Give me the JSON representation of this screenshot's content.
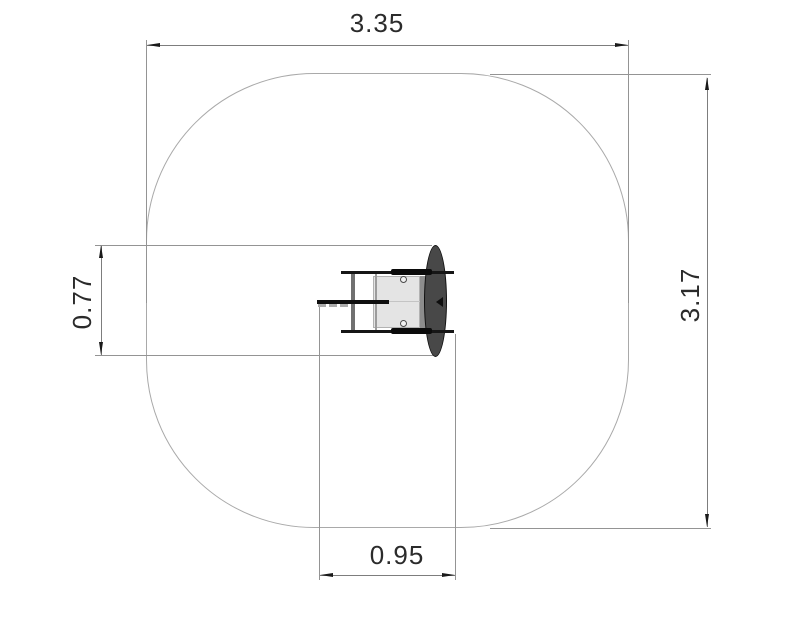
{
  "drawing": {
    "kind": "plan-view dimension drawing",
    "dimensions": {
      "overall_width": {
        "label": "3.35"
      },
      "overall_height": {
        "label": "3.17"
      },
      "equipment_depth": {
        "label": "0.77"
      },
      "equipment_width": {
        "label": "0.95"
      }
    },
    "colors": {
      "background": "#ffffff",
      "outline_gray": "#a9a9a9",
      "dimension_line_gray": "#7d7d7d",
      "extension_line_gray": "#949494",
      "arrow_black": "#1a1a1a",
      "text": "#2b2b2b",
      "equipment_dark": "#484848",
      "equipment_light": "#e4e4e4"
    }
  }
}
